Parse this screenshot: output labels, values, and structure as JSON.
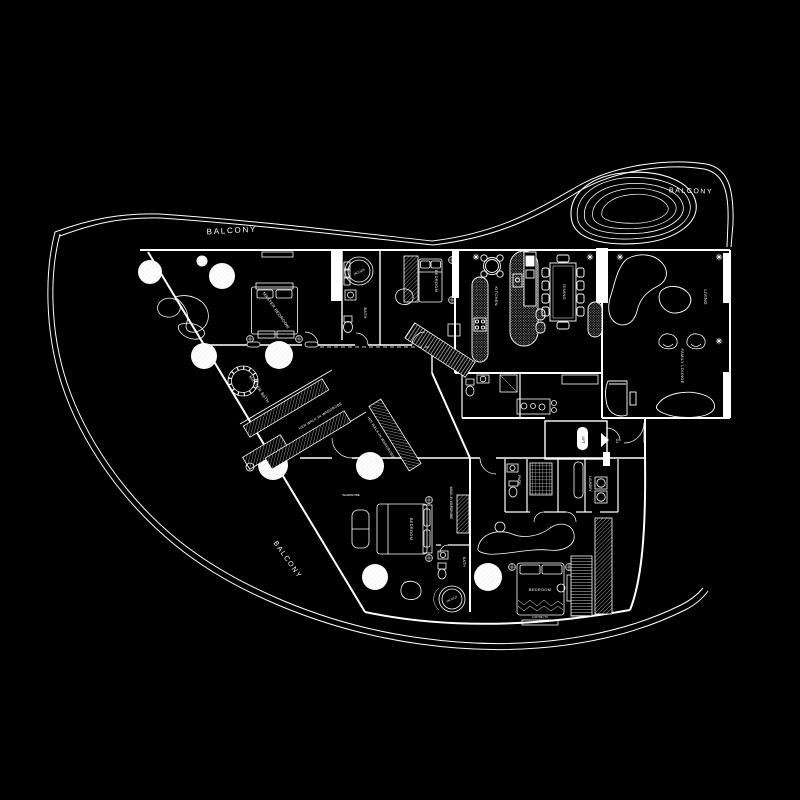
{
  "colors": {
    "background": "#000000",
    "line": "#ffffff"
  },
  "plan": {
    "balcony_top": "BALCONY",
    "balcony_right": "BALCONY",
    "balcony_left": "BALCONY",
    "master_bedroom": "MASTER BEDROOM",
    "master_bath": "MASTER BATH",
    "her_wardrobe": "HER WALK-IN WARDROBE",
    "his_wardrobe": "HIS WALK-IN WARDROBE",
    "jacuzzi_master": "JACUZZI",
    "bath_master": "BATH",
    "bedroom_top": "BEDROOM",
    "kitchen": "KITCHEN",
    "dining": "DINING",
    "living": "LIVING",
    "family_lounge": "FAMILY LOUNGE",
    "bedroom_left": "BEDROOM",
    "wardrobe_small": "WARDROBE",
    "walkin_wardrobe": "WALK-IN WARDROBE",
    "bath_left": "BATH",
    "jacuzzi_left": "JACUZZI",
    "bedroom_right": "BEDROOM",
    "tv": "LCD 50in TV",
    "pwdr": "PWDR",
    "laundry": "LAUNDRY",
    "lift": "LIFT",
    "unit_number": "01"
  }
}
